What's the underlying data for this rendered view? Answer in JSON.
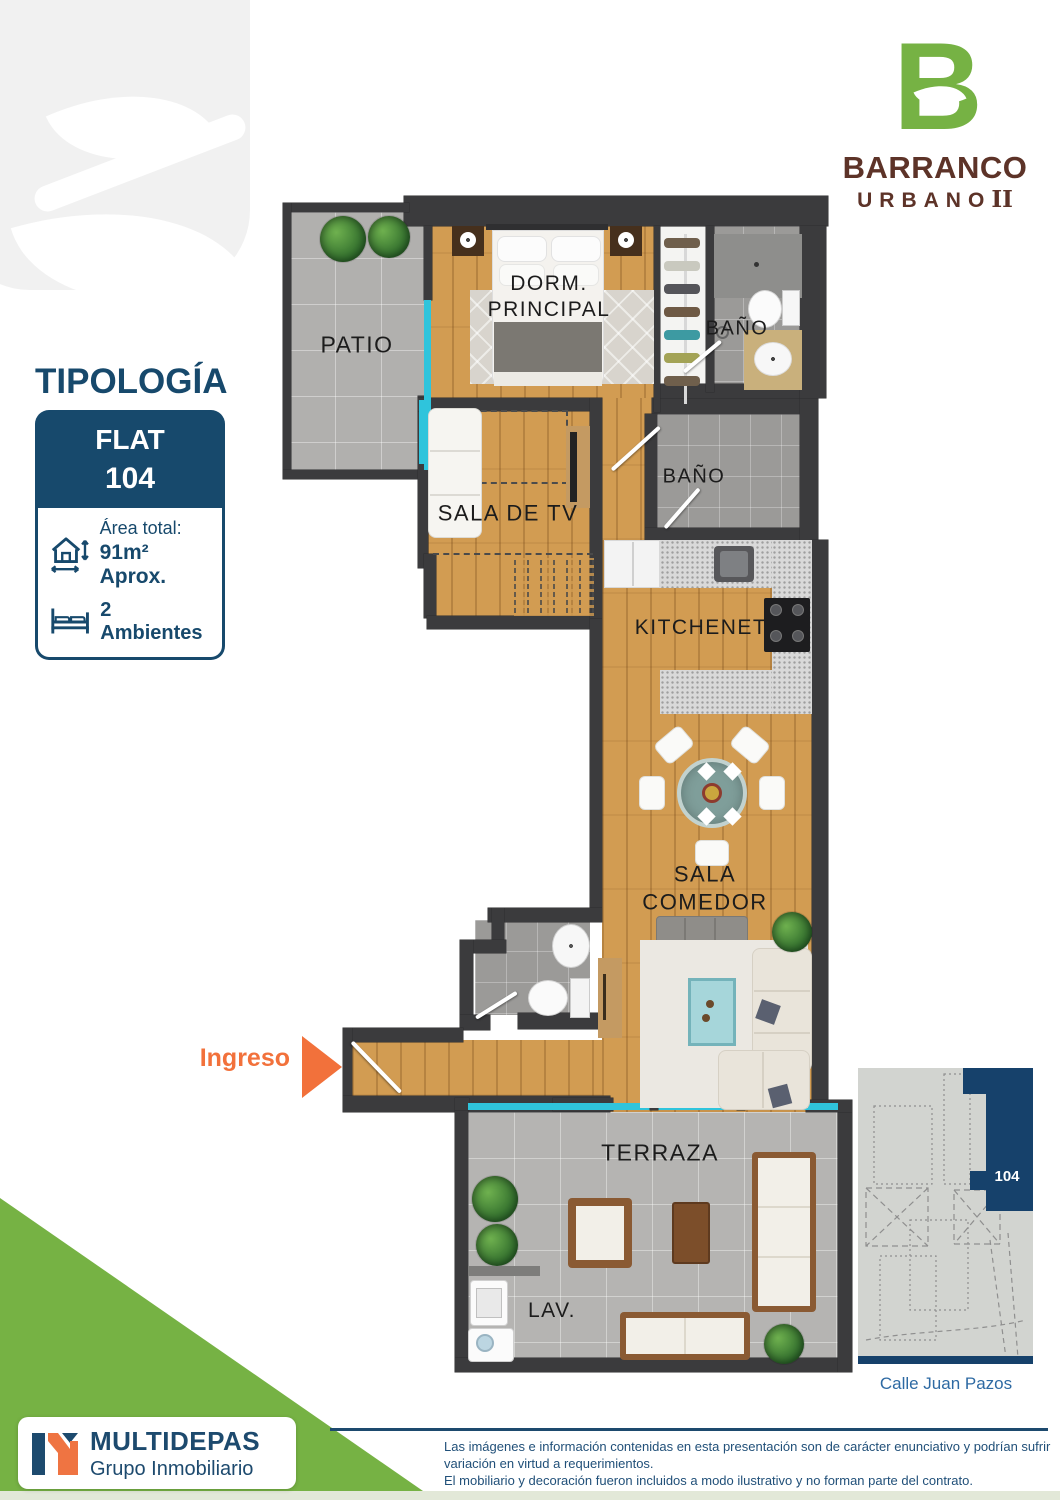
{
  "colors": {
    "navy": "#17496C",
    "map_navy": "#16416B",
    "green": "#76B244",
    "brown": "#5D3328",
    "orange": "#F2713B",
    "wall": "#3B3B3D",
    "cyan_window": "#2FC4DC",
    "street_blue": "#2E6AA3"
  },
  "brand": {
    "letter": "B",
    "line1": "BARRANCO",
    "word2": "URBANO",
    "numeral": "II"
  },
  "typology": {
    "heading": "TIPOLOGÍA",
    "unit_type": "FLAT",
    "unit_number": "104",
    "area_label": "Área total:",
    "area_value": "91m² Aprox.",
    "ambientes": "2 Ambientes"
  },
  "floorplan": {
    "entry_label": "Ingreso",
    "labels": {
      "patio": "PATIO",
      "dorm": "DORM.\nPRINCIPAL",
      "bano1": "BAÑO",
      "sala_tv": "SALA DE TV",
      "bano2": "BAÑO",
      "kitchenet": "KITCHENET",
      "sala_comedor": "SALA\nCOMEDOR",
      "terraza": "TERRAZA",
      "lav": "LAV."
    }
  },
  "site_map": {
    "unit_label": "104",
    "street_label": "Calle Juan Pazos"
  },
  "footer": {
    "company": "MULTIDEPAS",
    "tagline": "Grupo Inmobiliario",
    "disclaimer": [
      "Las imágenes e información contenidas en esta presentación son de carácter enunciativo y podrían sufrir",
      "variación en virtud a requerimientos.",
      "El mobiliario y decoración fueron incluidos a modo ilustrativo y no forman parte del contrato."
    ]
  }
}
